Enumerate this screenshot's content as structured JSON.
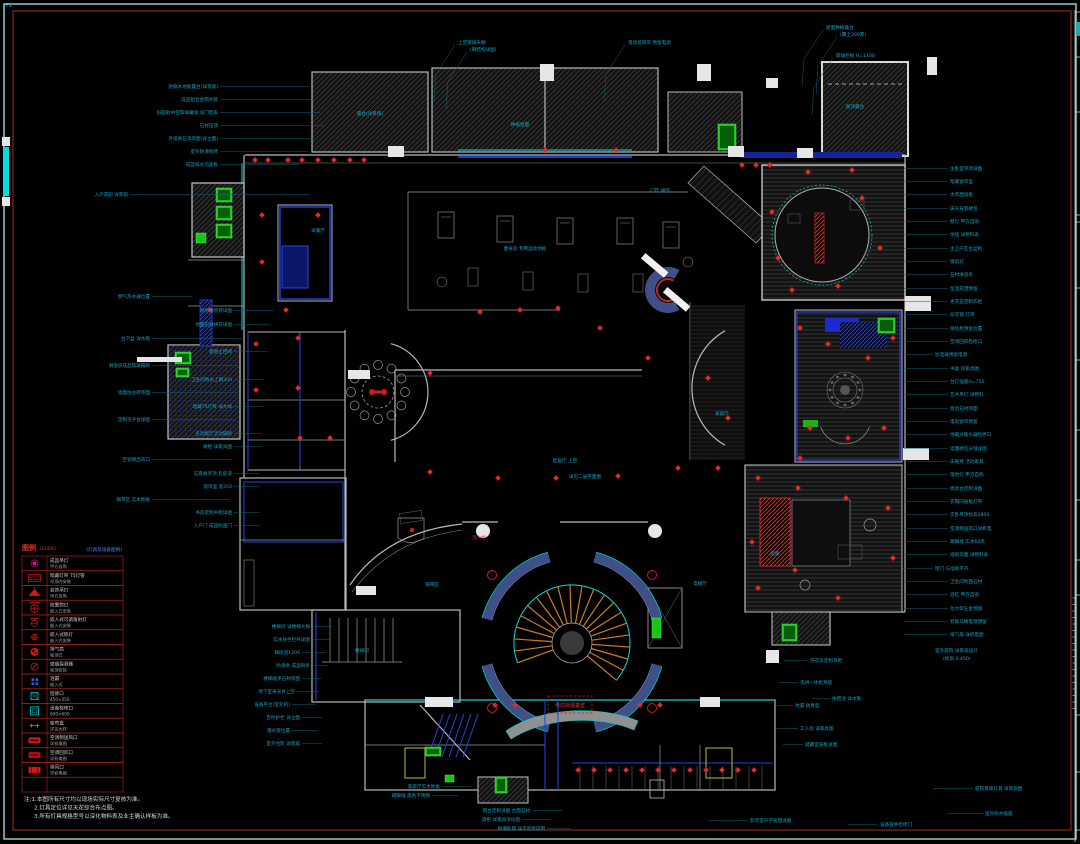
{
  "colors": {
    "frame_outer": "#9ad8d8",
    "frame_inner": "#8a241a",
    "wall_blue": "#2442e6",
    "cyan": "#00dcdc",
    "label": "#18a2c2",
    "leader": "#0d6272",
    "red": "#d41818",
    "green": "#17c517",
    "stair_orange": "#cf7d1e",
    "legend_border": "#a02018",
    "legend_text": "#cfcfcf",
    "note_text": "#d8d8d8"
  },
  "drawing": {
    "corner_note": "F1"
  },
  "legend": {
    "title": "图例",
    "subtitle": "LEGEND",
    "note": "(灯具及设备图例)",
    "rows": [
      {
        "icon": "pendant",
        "name": "成品吊灯",
        "spec": "甲方自购"
      },
      {
        "icon": "strip",
        "name": "暗藏灯带 T5灯管",
        "spec": "吊顶内安装"
      },
      {
        "icon": "deco-pendant",
        "name": "装饰吊灯",
        "spec": "甲方自购"
      },
      {
        "icon": "downlight-fog",
        "name": "防雾筒灯",
        "spec": "嵌入式安装"
      },
      {
        "icon": "adj-spot",
        "name": "嵌入式可调角射灯",
        "spec": "嵌入式安装"
      },
      {
        "icon": "downlight",
        "name": "嵌入式筒灯",
        "spec": "嵌入式安装"
      },
      {
        "icon": "exhaust-fan",
        "name": "排气扇",
        "spec": "吸顶式"
      },
      {
        "icon": "smoke",
        "name": "感烟探测器",
        "spec": "吸顶安装"
      },
      {
        "icon": "bath-heater",
        "name": "浴霸",
        "spec": "嵌入式"
      },
      {
        "icon": "access-450",
        "name": "检修口",
        "spec": "450×450"
      },
      {
        "icon": "access-600",
        "name": "设备检修口",
        "spec": "600×600"
      },
      {
        "icon": "curtain-box",
        "name": "窗帘盒",
        "spec": "详见大样"
      },
      {
        "icon": "vent-a",
        "name": "空调侧送风口",
        "spec": "详机电图"
      },
      {
        "icon": "vent-b",
        "name": "空调回风口",
        "spec": "详机电图"
      },
      {
        "icon": "vent-c",
        "name": "排风口",
        "spec": "详机电图"
      },
      {
        "icon": "",
        "name": "",
        "spec": ""
      }
    ]
  },
  "notes": [
    "注:1.本图所有尺寸均以现场实际尺寸复核为准。",
    "2.灯具定位详见天花综合布点图。",
    "3.所有灯具规格型号以深化物料表及业主确认样板为准。"
  ],
  "red_box_label": "电动挡烟垂壁",
  "red_texts": [
    [
      472,
      539,
      "消火栓"
    ]
  ],
  "annotations": [
    [
      218,
      88,
      "r",
      "防腐木地板露台(详景观)",
      90
    ],
    [
      218,
      101,
      "r",
      "成品铝合金雨水管",
      95
    ],
    [
      218,
      114,
      "r",
      "低辐射中空玻璃幕墙 详门窗表",
      100
    ],
    [
      218,
      127,
      "r",
      "石材压顶",
      105
    ],
    [
      218,
      140,
      "r",
      "外墙真石漆饰面(详立面)",
      95
    ],
    [
      218,
      153,
      "r",
      "室外防滑地砖",
      88
    ],
    [
      218,
      166,
      "r",
      "成品排水沟盖板",
      80
    ],
    [
      128,
      196,
      "r",
      "入户花园 详景观",
      180
    ],
    [
      150,
      298,
      "r",
      "燃气热水器位置",
      40
    ],
    [
      232,
      312,
      "r",
      "厨房精装修详图",
      40
    ],
    [
      232,
      326,
      "r",
      "地面石材拼花详图",
      36
    ],
    [
      150,
      340,
      "r",
      "台下盆 详水施",
      90
    ],
    [
      232,
      353,
      "r",
      "烟道止回阀",
      34
    ],
    [
      150,
      367,
      "r",
      "淋浴房成品玻璃隔断",
      88
    ],
    [
      232,
      381,
      "r",
      "卫生间防水上翻300",
      30
    ],
    [
      150,
      394,
      "r",
      "墙面仿古砖饰面",
      86
    ],
    [
      232,
      408,
      "r",
      "暗藏T5灯带 详大样",
      30
    ],
    [
      150,
      421,
      "r",
      "定制洗手台详图",
      84
    ],
    [
      232,
      435,
      "r",
      "多功能厅活动隔断",
      28
    ],
    [
      232,
      448,
      "r",
      "矮柜 详家具图",
      28
    ],
    [
      150,
      461,
      "r",
      "空调侧出风口",
      80
    ],
    [
      232,
      475,
      "r",
      "石膏板吊顶 乳胶漆",
      26
    ],
    [
      232,
      488,
      "r",
      "窗帘盒 宽350",
      26
    ],
    [
      150,
      501,
      "r",
      "钢琴区 实木地板",
      78
    ],
    [
      232,
      514,
      "r",
      "书房定制书柜详图",
      26
    ],
    [
      232,
      527,
      "r",
      "入户门 成品防盗门",
      26
    ],
    [
      310,
      628,
      "r",
      "楼梯间 详楼梯大样",
      20
    ],
    [
      310,
      641,
      "r",
      "实木扶手栏杆详图",
      18
    ],
    [
      300,
      654,
      "r",
      "梯段宽1200",
      24
    ],
    [
      310,
      667,
      "r",
      "防滑条 成品铜条",
      16
    ],
    [
      300,
      680,
      "r",
      "楼梯踏步石材饰面",
      20
    ],
    [
      295,
      693,
      "r",
      "地下室采光井上空",
      22
    ],
    [
      290,
      706,
      "r",
      "设备平台(室外机)",
      24
    ],
    [
      300,
      719,
      "r",
      "百叶护栏 详立面",
      20
    ],
    [
      290,
      732,
      "r",
      "落水管位置",
      26
    ],
    [
      300,
      745,
      "r",
      "室外台阶 详景观",
      20
    ],
    [
      440,
      788,
      "r",
      "家庭厅实木地板",
      30
    ],
    [
      430,
      797,
      "r",
      "踢脚线 黑色不锈钢",
      26
    ],
    [
      530,
      812,
      "r",
      "吧台定制详图 台面石材",
      30
    ],
    [
      520,
      821,
      "r",
      "酒柜 详家具深化图",
      28
    ],
    [
      545,
      830,
      "r",
      "防潮处理 详见装修说明",
      24
    ],
    [
      750,
      822,
      "l",
      "影音室声学处理详图",
      40
    ],
    [
      880,
      826,
      "l",
      "设备管井检修门",
      30
    ],
    [
      975,
      790,
      "l",
      "庭院景观灯具 详景观图",
      40
    ],
    [
      985,
      815,
      "l",
      "室外防水插座",
      36
    ],
    [
      458,
      44,
      "t",
      "上空玻璃天棚",
      0
    ],
    [
      470,
      51,
      "t",
      "(钢结构详图)",
      0
    ],
    [
      628,
      44,
      "t",
      "电动遮阳帘 预留电源",
      0
    ],
    [
      826,
      29,
      "t",
      "屋面种植露台",
      0
    ],
    [
      840,
      36,
      "t",
      "(覆土300厚)",
      0
    ],
    [
      836,
      57,
      "t",
      "玻璃栏板 H=1100",
      0
    ],
    [
      950,
      170,
      "l",
      "主卧室吊顶详图",
      44
    ],
    [
      950,
      183,
      "l",
      "暗藏窗帘盒",
      44
    ],
    [
      950,
      196,
      "l",
      "木饰面墙板",
      44
    ],
    [
      950,
      210,
      "l",
      "床头背景硬包",
      44
    ],
    [
      950,
      223,
      "l",
      "壁灯 甲方自购",
      44
    ],
    [
      950,
      236,
      "l",
      "地毯 详物料表",
      44
    ],
    [
      950,
      250,
      "l",
      "主卫干区台盆柜",
      44
    ],
    [
      950,
      263,
      "l",
      "镜前灯",
      44
    ],
    [
      950,
      276,
      "l",
      "石材淋浴房",
      44
    ],
    [
      950,
      290,
      "l",
      "恒温花洒预留",
      44
    ],
    [
      950,
      303,
      "l",
      "更衣室定制衣柜",
      44
    ],
    [
      950,
      316,
      "l",
      "穿衣镜 灯带",
      44
    ],
    [
      950,
      330,
      "l",
      "保险柜预留位置",
      44
    ],
    [
      950,
      343,
      "l",
      "空调回风检修口",
      44
    ],
    [
      935,
      356,
      "l",
      "加湿器预留电源",
      30
    ],
    [
      950,
      370,
      "l",
      "书桌 详家具图",
      44
    ],
    [
      950,
      383,
      "l",
      "台灯插座H=750",
      44
    ],
    [
      950,
      396,
      "l",
      "艺术吊灯 详物料",
      44
    ],
    [
      950,
      410,
      "l",
      "窗台石材饰面",
      44
    ],
    [
      950,
      423,
      "l",
      "电动窗帘预留",
      44
    ],
    [
      950,
      436,
      "l",
      "地暖分集水器检修口",
      44
    ],
    [
      950,
      450,
      "l",
      "墙面硬包分缝详图",
      44
    ],
    [
      950,
      463,
      "l",
      "床尾凳 活动家具",
      44
    ],
    [
      950,
      476,
      "l",
      "落地灯 甲方自购",
      44
    ],
    [
      950,
      490,
      "l",
      "梳妆台定制详图",
      44
    ],
    [
      950,
      503,
      "l",
      "衣帽间层板灯带",
      44
    ],
    [
      950,
      516,
      "l",
      "次卧吊顶标高2800",
      44
    ],
    [
      950,
      530,
      "l",
      "空调侧送风口详机电",
      44
    ],
    [
      950,
      543,
      "l",
      "踢脚线 实木60高",
      44
    ],
    [
      950,
      556,
      "l",
      "墙纸饰面 详物料表",
      44
    ],
    [
      935,
      570,
      "l",
      "暗门 与墙板平齐",
      30
    ],
    [
      950,
      583,
      "l",
      "卫生间地面石材",
      44
    ],
    [
      950,
      596,
      "l",
      "浴缸 甲方自购",
      44
    ],
    [
      950,
      610,
      "l",
      "毛巾架五金预留",
      44
    ],
    [
      950,
      623,
      "l",
      "智能马桶电源预留",
      44
    ],
    [
      950,
      636,
      "l",
      "排气扇 详机电图",
      44
    ],
    [
      935,
      652,
      "l",
      "室外庭院 详景观设计",
      0
    ],
    [
      943,
      660,
      "l",
      "(标高-0.450)",
      0
    ],
    [
      810,
      662,
      "l",
      "洗衣房定制吊柜",
      24
    ],
    [
      800,
      684,
      "l",
      "洗烘一体机预留",
      20
    ],
    [
      832,
      700,
      "l",
      "拖把池 详水施",
      18
    ],
    [
      795,
      707,
      "l",
      "地漏 防臭型",
      16
    ],
    [
      800,
      730,
      "l",
      "工人房 详家具图",
      22
    ],
    [
      805,
      746,
      "l",
      "储藏室层板详图",
      20
    ],
    [
      525,
      250,
      "m",
      "健身房 专用运动地板",
      0
    ],
    [
      318,
      232,
      "m",
      "早餐厅",
      0
    ],
    [
      660,
      192,
      "m",
      "门厅 挑空",
      0
    ],
    [
      855,
      108,
      "m",
      "屋顶露台",
      0
    ],
    [
      520,
      126,
      "m",
      "种植屋面",
      0
    ],
    [
      370,
      115,
      "m",
      "露台(详景观)",
      0
    ],
    [
      565,
      462,
      "m",
      "起居厅 上空",
      0
    ],
    [
      585,
      478,
      "m",
      "详见二层平面图",
      0
    ],
    [
      432,
      586,
      "m",
      "钢琴区",
      0
    ],
    [
      362,
      652,
      "m",
      "楼梯间",
      0
    ],
    [
      700,
      585,
      "m",
      "电梯厅",
      0
    ],
    [
      775,
      555,
      "m",
      "走廊",
      0
    ],
    [
      722,
      415,
      "m",
      "家庭厅",
      0
    ]
  ],
  "plan": {
    "red_fixtures": [
      [
        255,
        160
      ],
      [
        268,
        160
      ],
      [
        288,
        160
      ],
      [
        302,
        160
      ],
      [
        318,
        160
      ],
      [
        334,
        160
      ],
      [
        350,
        160
      ],
      [
        364,
        160
      ],
      [
        742,
        165
      ],
      [
        756,
        165
      ],
      [
        770,
        165
      ],
      [
        398,
        150
      ],
      [
        545,
        150
      ],
      [
        616,
        150
      ],
      [
        772,
        212
      ],
      [
        778,
        258
      ],
      [
        792,
        290
      ],
      [
        838,
        286
      ],
      [
        862,
        198
      ],
      [
        880,
        248
      ],
      [
        808,
        172
      ],
      [
        852,
        170
      ],
      [
        800,
        328
      ],
      [
        828,
        344
      ],
      [
        868,
        358
      ],
      [
        893,
        338
      ],
      [
        810,
        428
      ],
      [
        848,
        438
      ],
      [
        884,
        428
      ],
      [
        800,
        458
      ],
      [
        758,
        478
      ],
      [
        798,
        488
      ],
      [
        846,
        498
      ],
      [
        888,
        508
      ],
      [
        752,
        542
      ],
      [
        893,
        558
      ],
      [
        758,
        588
      ],
      [
        838,
        598
      ],
      [
        795,
        570
      ],
      [
        430,
        373
      ],
      [
        298,
        338
      ],
      [
        256,
        344
      ],
      [
        298,
        388
      ],
      [
        256,
        390
      ],
      [
        300,
        438
      ],
      [
        330,
        438
      ],
      [
        430,
        472
      ],
      [
        498,
        478
      ],
      [
        556,
        478
      ],
      [
        618,
        476
      ],
      [
        678,
        468
      ],
      [
        718,
        468
      ],
      [
        728,
        418
      ],
      [
        708,
        378
      ],
      [
        648,
        358
      ],
      [
        600,
        328
      ],
      [
        558,
        308
      ],
      [
        520,
        310
      ],
      [
        480,
        312
      ],
      [
        262,
        215
      ],
      [
        262,
        262
      ],
      [
        318,
        215
      ],
      [
        210,
        310
      ],
      [
        286,
        310
      ],
      [
        578,
        770
      ],
      [
        594,
        770
      ],
      [
        610,
        770
      ],
      [
        626,
        770
      ],
      [
        642,
        770
      ],
      [
        658,
        770
      ],
      [
        674,
        770
      ],
      [
        690,
        770
      ],
      [
        706,
        770
      ],
      [
        722,
        770
      ],
      [
        738,
        770
      ],
      [
        754,
        770
      ],
      [
        495,
        705
      ],
      [
        515,
        705
      ],
      [
        640,
        705
      ],
      [
        660,
        705
      ]
    ],
    "red_rings": [
      [
        492,
        575
      ],
      [
        652,
        575
      ],
      [
        492,
        708
      ],
      [
        652,
        708
      ]
    ],
    "green_blocks": [
      [
        216,
        188,
        16,
        14
      ],
      [
        216,
        206,
        16,
        14
      ],
      [
        216,
        224,
        16,
        14
      ],
      [
        196,
        233,
        10,
        10
      ],
      [
        175,
        352,
        16,
        12
      ],
      [
        176,
        368,
        13,
        9
      ],
      [
        718,
        124,
        18,
        26
      ],
      [
        878,
        318,
        17,
        15
      ],
      [
        782,
        624,
        15,
        17
      ],
      [
        425,
        747,
        16,
        9
      ],
      [
        495,
        777,
        12,
        16
      ],
      [
        652,
        618,
        9,
        20
      ],
      [
        445,
        775,
        9,
        7
      ]
    ],
    "white_blocks": [
      [
        388,
        146,
        16,
        11
      ],
      [
        540,
        64,
        14,
        17
      ],
      [
        697,
        64,
        14,
        17
      ],
      [
        728,
        146,
        16,
        11
      ],
      [
        797,
        148,
        16,
        10
      ],
      [
        905,
        296,
        26,
        15
      ],
      [
        903,
        448,
        26,
        12
      ],
      [
        348,
        370,
        22,
        9
      ],
      [
        356,
        586,
        20,
        9
      ],
      [
        425,
        697,
        28,
        10
      ],
      [
        700,
        697,
        20,
        10
      ],
      [
        766,
        650,
        13,
        13
      ],
      [
        927,
        57,
        10,
        18
      ],
      [
        766,
        78,
        12,
        10
      ],
      [
        137,
        357,
        45,
        5
      ],
      [
        2,
        137,
        8,
        9
      ],
      [
        2,
        197,
        8,
        9
      ]
    ]
  }
}
